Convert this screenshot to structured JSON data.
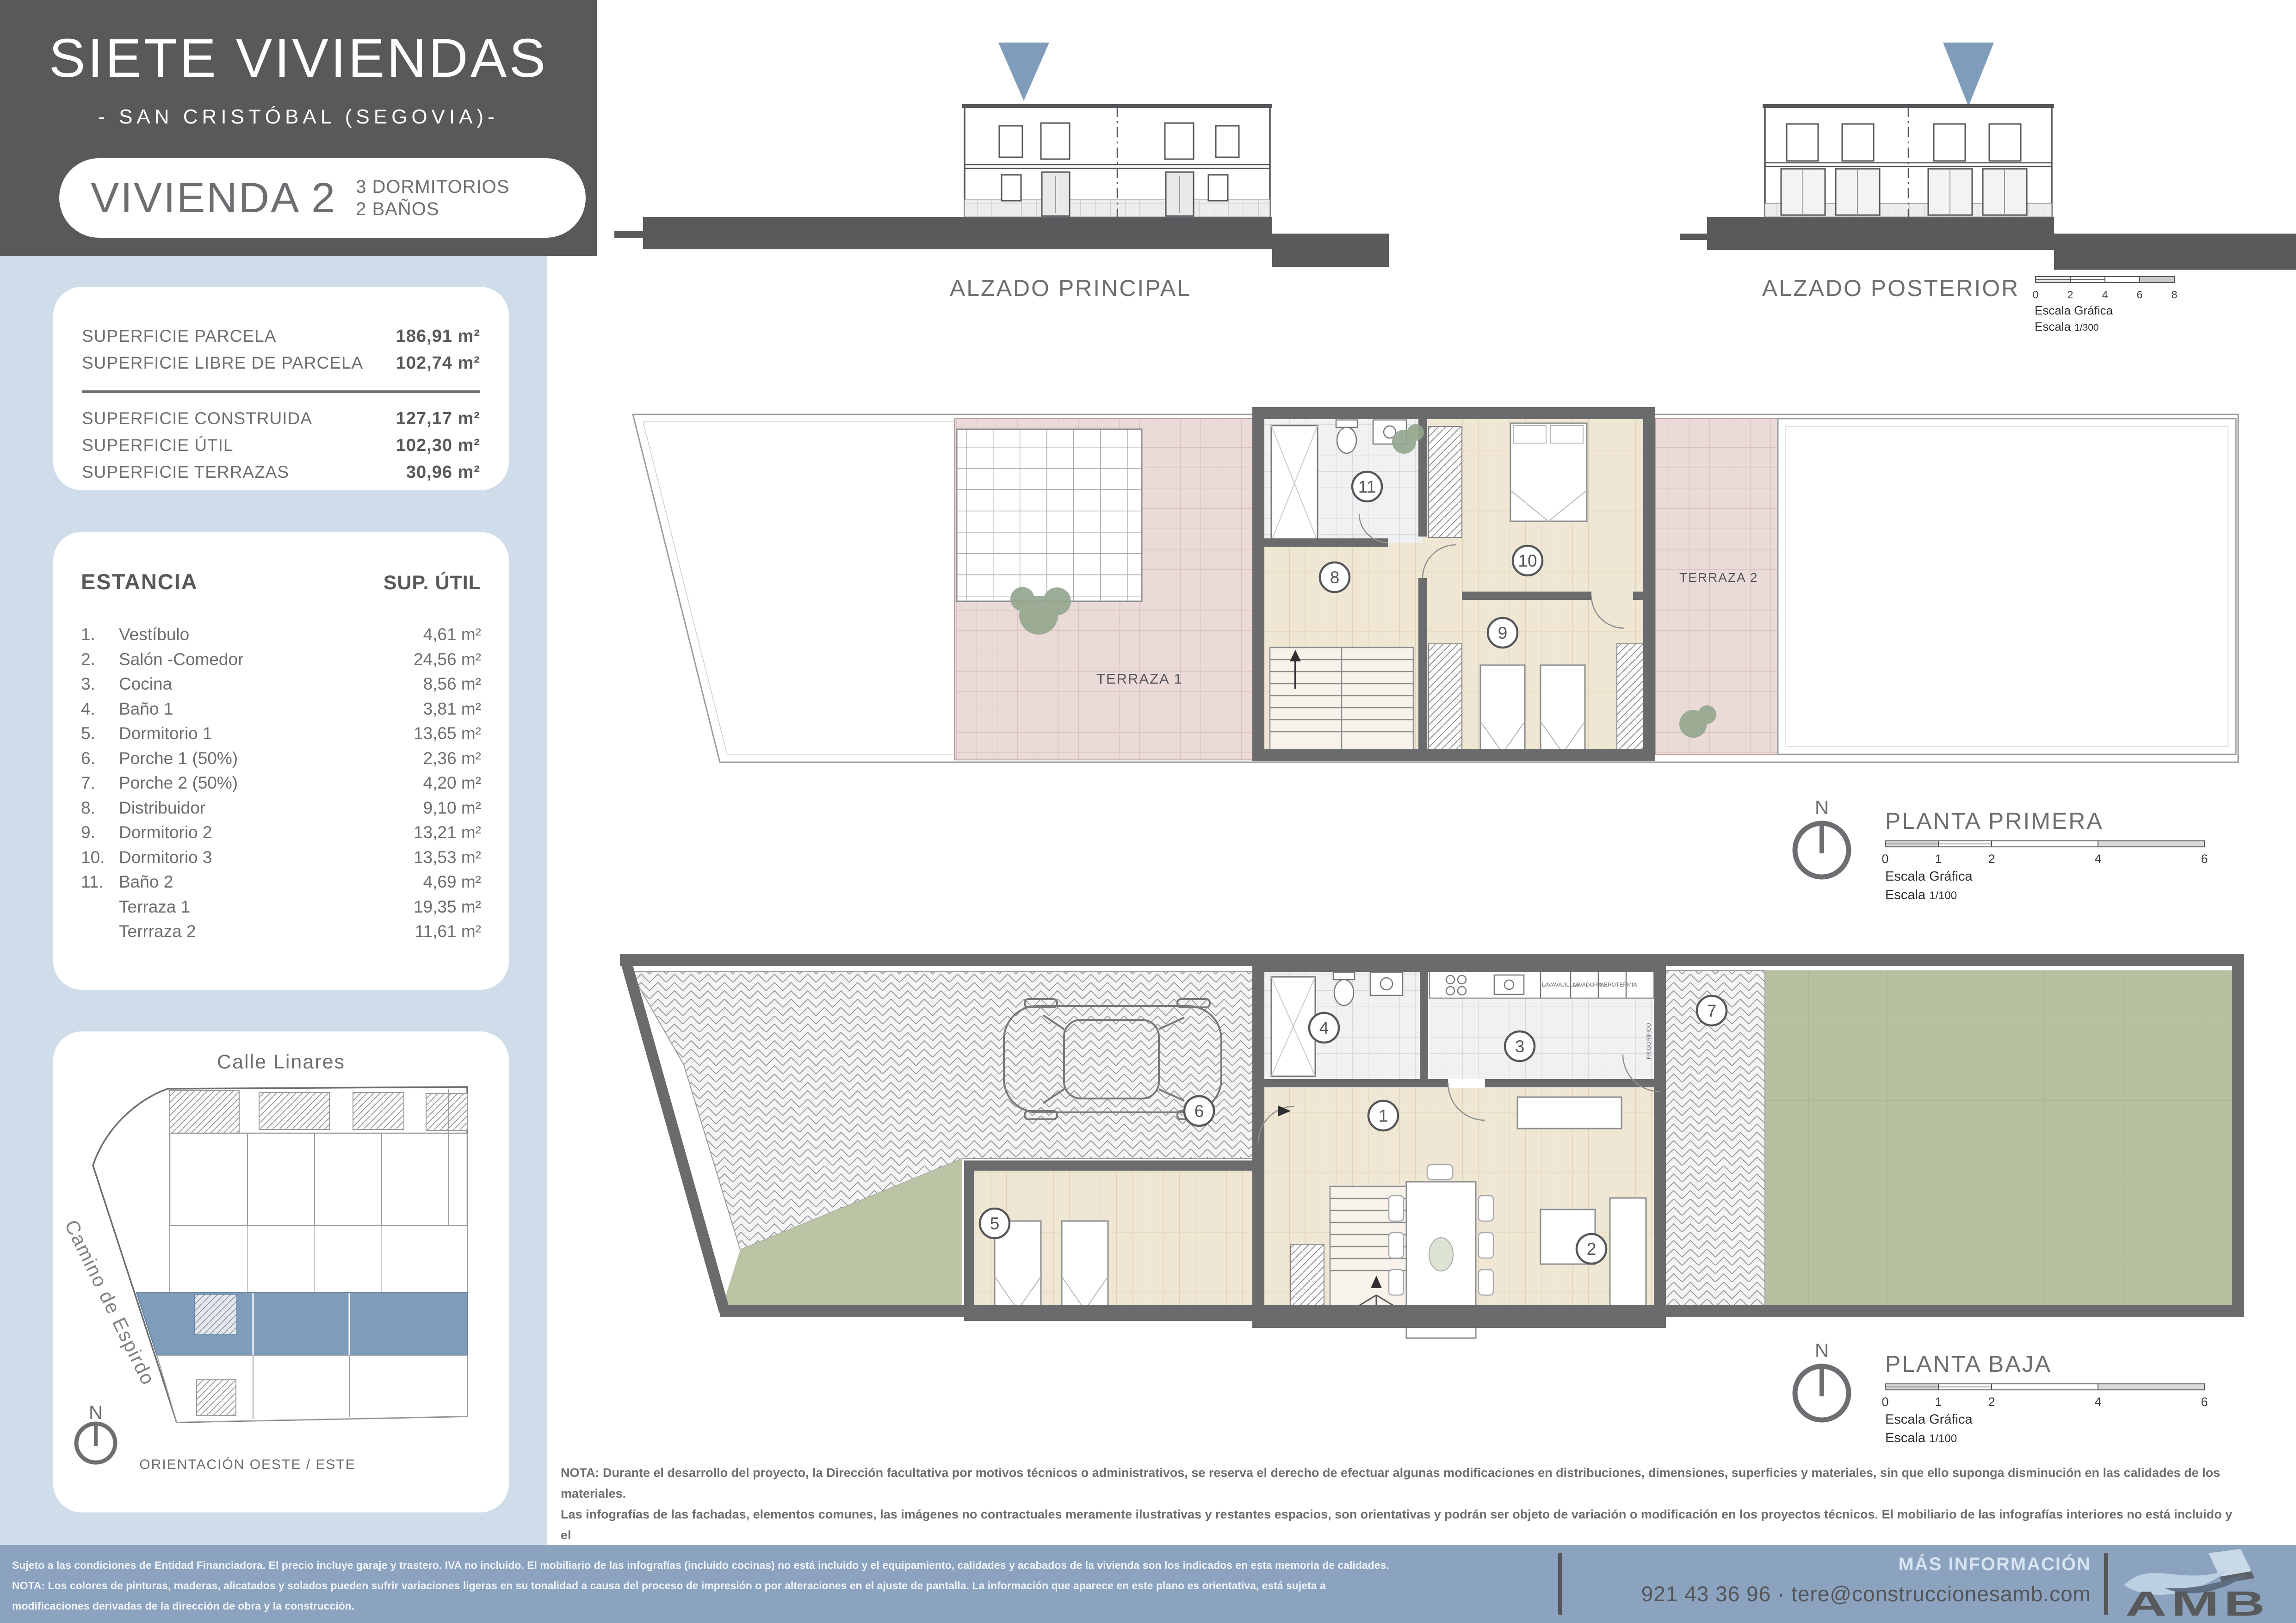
{
  "colors": {
    "header_bg": "#58595B",
    "panel_blue": "#CFDDEB",
    "accent_blue": "#7F9CBB",
    "footer_bg": "#8BA3BE",
    "text_gray": "#6D6E71",
    "terrace_pink": "#EBDBD8",
    "wood": "#EFE6D4",
    "lawn_green": "#B9C2A4",
    "wall_gray": "#6A6B6D"
  },
  "header": {
    "title": "SIETE VIVIENDAS",
    "subtitle": "- SAN CRISTÓBAL (SEGOVIA)-",
    "unit_name": "VIVIENDA 2",
    "unit_feature_1": "3 DORMITORIOS",
    "unit_feature_2": "2 BAÑOS"
  },
  "surfaces": {
    "rows_top": [
      {
        "label": "SUPERFICIE PARCELA",
        "value": "186,91 m²"
      },
      {
        "label": "SUPERFICIE LIBRE DE PARCELA",
        "value": "102,74 m²"
      }
    ],
    "rows_bottom": [
      {
        "label": "SUPERFICIE CONSTRUIDA",
        "value": "127,17 m²"
      },
      {
        "label": "SUPERFICIE ÚTIL",
        "value": "102,30 m²"
      },
      {
        "label": "SUPERFICIE TERRAZAS",
        "value": "30,96 m²"
      }
    ]
  },
  "estancia": {
    "col_room": "ESTANCIA",
    "col_area": "SUP. ÚTIL",
    "rows": [
      {
        "num": "1.",
        "name": "Vestíbulo",
        "value": "4,61 m²"
      },
      {
        "num": "2.",
        "name": "Salón -Comedor",
        "value": "24,56 m²"
      },
      {
        "num": "3.",
        "name": "Cocina",
        "value": "8,56 m²"
      },
      {
        "num": "4.",
        "name": "Baño 1",
        "value": "3,81 m²"
      },
      {
        "num": "5.",
        "name": "Dormitorio 1",
        "value": "13,65 m²"
      },
      {
        "num": "6.",
        "name": "Porche 1 (50%)",
        "value": "2,36 m²"
      },
      {
        "num": "7.",
        "name": "Porche 2 (50%)",
        "value": "4,20 m²"
      },
      {
        "num": "8.",
        "name": "Distribuidor",
        "value": "9,10 m²"
      },
      {
        "num": "9.",
        "name": "Dormitorio 2",
        "value": "13,21 m²"
      },
      {
        "num": "10.",
        "name": "Dormitorio 3",
        "value": "13,53 m²"
      },
      {
        "num": "11.",
        "name": "Baño 2",
        "value": "4,69 m²"
      },
      {
        "num": "",
        "name": "Terraza 1",
        "value": "19,35 m²"
      },
      {
        "num": "",
        "name": "Terrraza 2",
        "value": "11,61 m²"
      }
    ]
  },
  "siteplan": {
    "street_top": "Calle Linares",
    "street_side": "Camino de Espirdo",
    "north": "N",
    "orientation": "ORIENTACIÓN OESTE / ESTE"
  },
  "alzados": {
    "principal": "ALZADO PRINCIPAL",
    "posterior": "ALZADO POSTERIOR",
    "scale_ticks": [
      "0",
      "2",
      "4",
      "6",
      "8"
    ],
    "scale_title": "Escala Gráfica",
    "scale_word": "Escala",
    "scale_value": "1/300"
  },
  "planta_primera": {
    "title": "PLANTA PRIMERA",
    "north": "N",
    "terraza1": "TERRAZA 1",
    "terraza2": "TERRAZA 2",
    "markers": {
      "m8": "8",
      "m9": "9",
      "m10": "10",
      "m11": "11"
    },
    "scale_ticks": [
      "0",
      "1",
      "2",
      "4",
      "6"
    ],
    "scale_title": "Escala Gráfica",
    "scale_word": "Escala",
    "scale_value": "1/100"
  },
  "planta_baja": {
    "title": "PLANTA BAJA",
    "north": "N",
    "markers": {
      "m1": "1",
      "m2": "2",
      "m3": "3",
      "m4": "4",
      "m5": "5",
      "m6": "6",
      "m7": "7"
    },
    "appliances": [
      "LAVAVAJILLAS",
      "LAVADORA",
      "AEROTERMIA"
    ],
    "fridge_label": "FRIGORÍFICO",
    "scale_ticks": [
      "0",
      "1",
      "2",
      "4",
      "6"
    ],
    "scale_title": "Escala Gráfica",
    "scale_word": "Escala",
    "scale_value": "1/100"
  },
  "nota": {
    "line1": "NOTA: Durante el desarrollo del proyecto, la Dirección facultativa por motivos técnicos o administrativos, se reserva  el derecho de efectuar  algunas modificaciones en distribuciones, dimensiones, superficies y materiales, sin que ello suponga disminución  en las calidades de los materiales.",
    "line2": "Las infografías de las fachadas, elementos comunes, las imágenes no contractuales  meramente ilustrativas y  restantes espacios, son orientativas y podrán ser objeto de variación o modificación en los proyectos técnicos. El mobiliario de las infografías interiores no está incluido y el",
    "line3": "equipamiento de las viviendas será el indicado en la correspondiente memoria de calidades."
  },
  "footer": {
    "disclaimer1": "Sujeto a las condiciones de Entidad Financiadora. El precio incluye garaje y trastero. IVA no incluido. El mobiliario de las infografías (incluido cocinas) no está incluido y el equipamiento, calidades y acabados de la vivienda son los indicados en esta memoria de calidades.",
    "disclaimer2": "NOTA: Los colores de pinturas, maderas, alicatados y solados pueden sufrir variaciones ligeras en su tonalidad a causa del proceso de impresión o por alteraciones en el ajuste de pantalla. La información que aparece en este plano es orientativa, está sujeta a",
    "disclaimer3": "modificaciones derivadas de la dirección de obra y la construcción.",
    "more_info": "MÁS INFORMACIÓN",
    "contact": "921 43 36 96  ·  tere@construccionesamb.com",
    "logo": "AMB"
  }
}
